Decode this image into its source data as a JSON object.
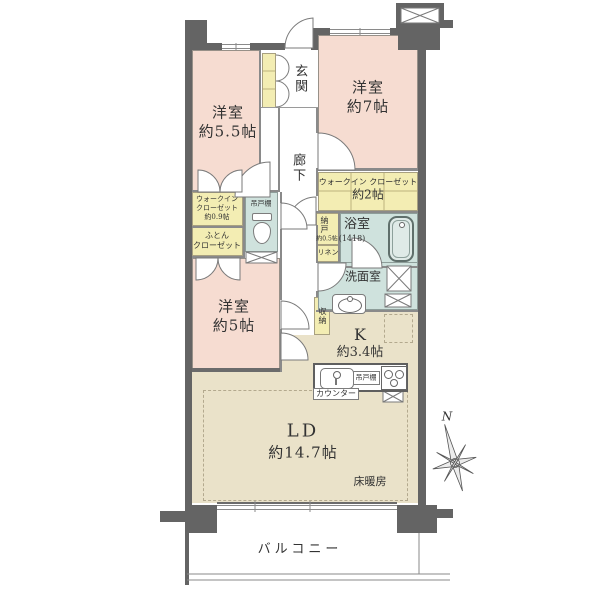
{
  "rooms": {
    "bedroom55": {
      "name": "洋室",
      "size": "約5.5帖"
    },
    "bedroom7": {
      "name": "洋室",
      "size": "約7帖"
    },
    "bedroom5": {
      "name": "洋室",
      "size": "約5帖"
    },
    "ld": {
      "name": "LD",
      "size": "約14.7帖"
    },
    "kitchen": {
      "name": "K",
      "size": "約3.4帖"
    },
    "entrance": {
      "name": "玄関"
    },
    "hallway": {
      "name": "廊下"
    },
    "bath": {
      "name": "浴室",
      "size": "(1418)"
    },
    "washroom": {
      "name": "洗面室"
    },
    "wic2": {
      "name": "ウォークイン クローゼット",
      "size": "約2帖"
    },
    "wic09": {
      "line1": "ウォークイン",
      "line2": "クローゼット",
      "line3": "約0.9帖"
    },
    "futon": {
      "line1": "ふとん",
      "line2": "クローゼット"
    },
    "nando": {
      "name": "納戸",
      "size": "約0.5帖"
    },
    "linen": {
      "name": "リネン"
    },
    "shuno": {
      "name": "収納"
    },
    "balcony": {
      "name": "バルコニー"
    }
  },
  "features": {
    "floor_heating": "床暖房",
    "toilet_shelf": "吊戸棚",
    "kitchen_shelf": "吊戸棚",
    "counter": "カウンター"
  },
  "compass": {
    "north": "N"
  },
  "colors": {
    "room_pink": "#f6dcd1",
    "ldk_beige": "#eae2c9",
    "closet_yellow": "#f3edb3",
    "wet_teal": "#cfe2dd",
    "wall": "#646464"
  }
}
